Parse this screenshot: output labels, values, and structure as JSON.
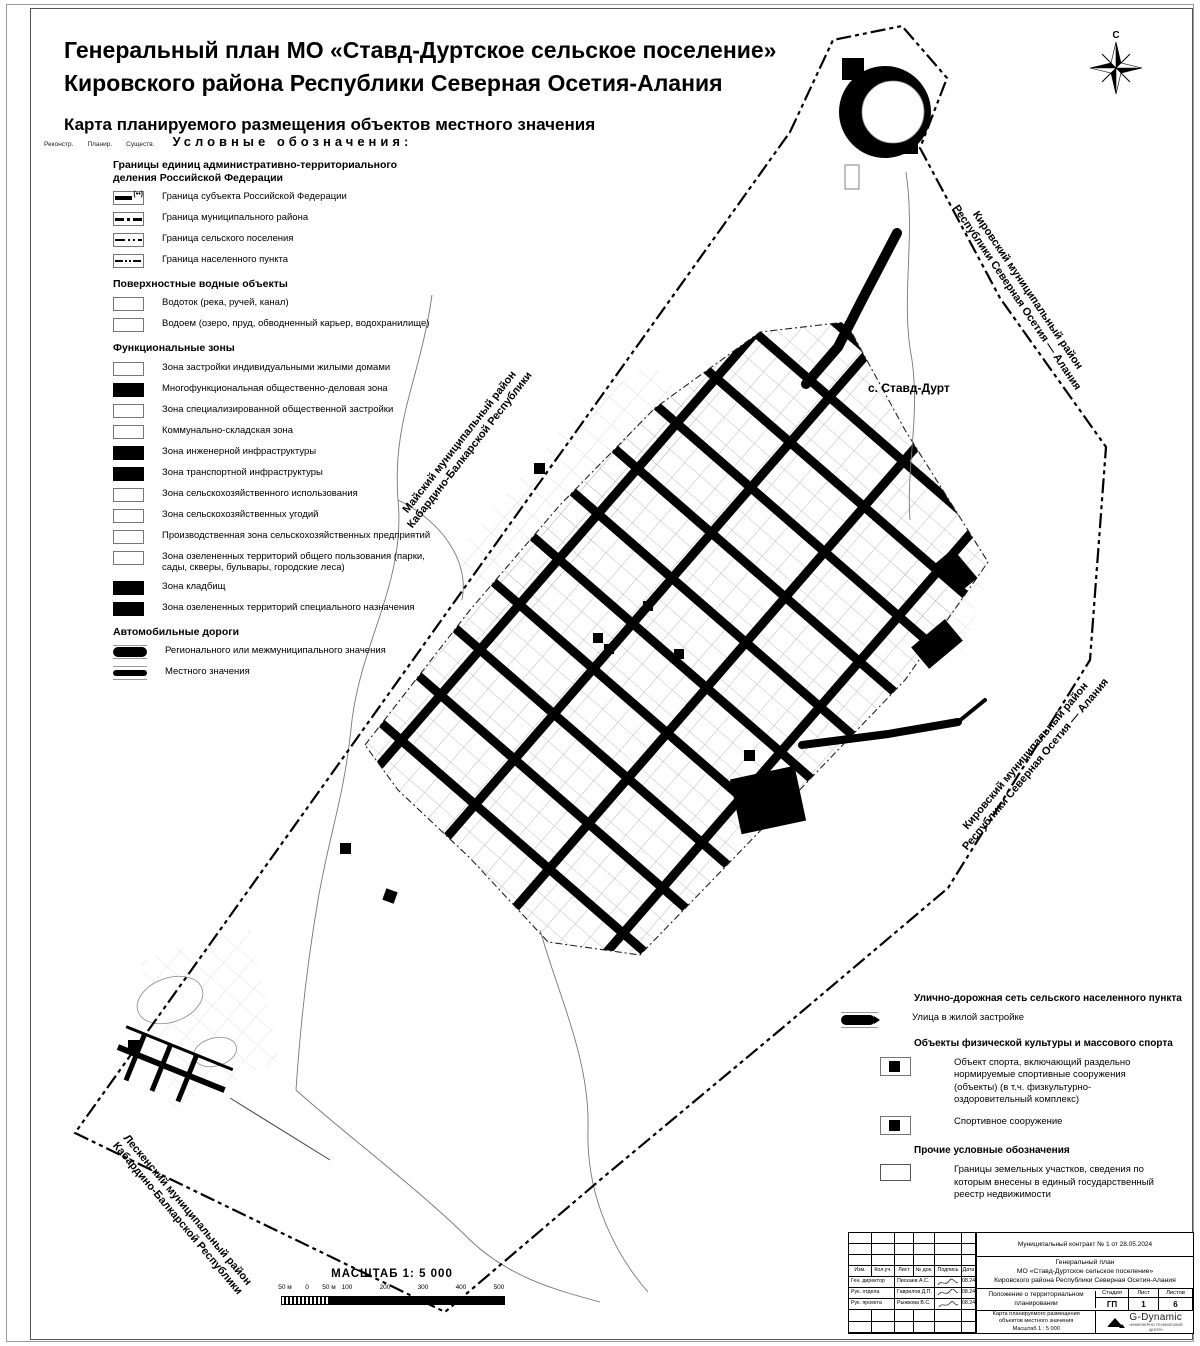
{
  "header": {
    "title_line1": "Генеральный план МО «Ставд-Дуртское сельское поселение»",
    "title_line2": "Кировского района Республики Северная Осетия-Алания",
    "subtitle": "Карта планируемого размещения объектов местного значения"
  },
  "compass": {
    "north_label": "С"
  },
  "legend": {
    "status_labels": [
      "Реконстр.",
      "Планир.",
      "Существ."
    ],
    "heading": "Условные обозначения:",
    "sections": [
      {
        "title": "Границы единиц административно-территориального\nделения Российской Федерации",
        "items": [
          {
            "symbol": "boundary-subject",
            "label": "Граница субъекта Российской Федерации"
          },
          {
            "symbol": "boundary-district",
            "label": "Граница муниципального района"
          },
          {
            "symbol": "boundary-settlement",
            "label": "Граница сельского поселения"
          },
          {
            "symbol": "boundary-locality",
            "label": "Граница населенного пункта"
          }
        ]
      },
      {
        "title": "Поверхностные водные объекты",
        "items": [
          {
            "symbol": "zone-white",
            "label": "Водоток (река, ручей, канал)"
          },
          {
            "symbol": "zone-white",
            "label": "Водоем (озеро, пруд, обводненный карьер, водохранилище)"
          }
        ]
      },
      {
        "title": "Функциональные зоны",
        "items": [
          {
            "symbol": "zone-white",
            "label": "Зона застройки индивидуальными жилыми домами"
          },
          {
            "symbol": "zone-black",
            "label": "Многофункциональная общественно-деловая зона"
          },
          {
            "symbol": "zone-white",
            "label": "Зона специализированной общественной застройки"
          },
          {
            "symbol": "zone-white",
            "label": "Коммунально-складская зона"
          },
          {
            "symbol": "zone-black",
            "label": "Зона инженерной инфраструктуры"
          },
          {
            "symbol": "zone-black",
            "label": "Зона транспортной инфраструктуры"
          },
          {
            "symbol": "zone-white",
            "label": "Зона сельскохозяйственного использования"
          },
          {
            "symbol": "zone-white",
            "label": "Зона сельскохозяйственных угодий"
          },
          {
            "symbol": "zone-white",
            "label": "Производственная зона сельскохозяйственных предприятий"
          },
          {
            "symbol": "zone-white",
            "label": "Зона озелененных территорий общего пользования (парки, сады, скверы, бульвары, городские леса)"
          },
          {
            "symbol": "zone-black",
            "label": "Зона кладбищ"
          },
          {
            "symbol": "zone-black",
            "label": "Зона озелененных территорий специального назначения"
          }
        ]
      },
      {
        "title": "Автомобильные дороги",
        "items": [
          {
            "symbol": "road-regional",
            "label": "Регионального или межмуниципального значения"
          },
          {
            "symbol": "road-local",
            "label": "Местного значения"
          }
        ]
      }
    ]
  },
  "legend_right": {
    "street_section_title": "Улично-дорожная сеть сельского населенного пункта",
    "street_label": "Улица в жилой застройке",
    "sport_section_title": "Объекты физической культуры и массового спорта",
    "sport_items": [
      {
        "symbol": "sport",
        "label": "Объект спорта, включающий раздельно нормируемые спортивные сооружения (объекты) (в т.ч. физкультурно-оздоровительный комплекс)"
      },
      {
        "symbol": "sport",
        "label": "Спортивное сооружение"
      }
    ],
    "other_section_title": "Прочие условные обозначения",
    "other_label": "Границы земельных участков, сведения по которым внесены в единый государственный реестр недвижимости"
  },
  "map": {
    "settlement_label": "с. Ставд-Дурт",
    "boundary_labels": {
      "kirovsky_ne_1": "Кировский муниципальный район",
      "kirovsky_ne_2": "Республики Северная Осетия — Алания",
      "kirovsky_se_1": "Кировский муниципальный район",
      "kirovsky_se_2": "Республики Северная Осетия — Алания",
      "maysky_1": "Майский муниципальный район",
      "maysky_2": "Кабардино-Балкарской Республики",
      "leskensky_1": "Лескенский муниципальный район",
      "leskensky_2": "Кабардино-Балкарской Республики"
    }
  },
  "scalebar": {
    "title": "МАСШТАБ 1: 5 000",
    "ticks": [
      "50 м",
      "0",
      "50 м",
      "100",
      "200",
      "300",
      "400",
      "500"
    ]
  },
  "titleblock": {
    "contract": "Муниципальный контракт № 1 от 28.05.2024",
    "project_lines": [
      "Генеральный план",
      "МО «Ставд-Дуртское сельское поселение»",
      "Кировского района Республики Северная Осетия-Алания"
    ],
    "doc_title": "Положение о территориальном планировании",
    "stage_headers": [
      "Стадия",
      "Лист",
      "Листов"
    ],
    "stage_values": [
      "ГП",
      "1",
      "6"
    ],
    "caption_lines": [
      "Карта планируемого размещения",
      "объектов местного значения",
      "Масштаб 1 : 5 000"
    ],
    "columns": [
      "Изм.",
      "Кол.уч.",
      "Лист",
      "№ док.",
      "Подпись",
      "Дата"
    ],
    "rows": [
      {
        "role": "Ген. директор",
        "name": "Пискаев А.С.",
        "date": "08.24"
      },
      {
        "role": "Рук. отдела",
        "name": "Гаврилов Д.П.",
        "date": "08.24"
      },
      {
        "role": "Рук. проекта",
        "name": "Рыжкова В.С.",
        "date": "08.24"
      }
    ],
    "logo_name": "G-Dynamic",
    "logo_sub_1": "«ИНЖЕНЕРНО-ТЕХНИЧЕСКИЙ",
    "logo_sub_2": "ЦЕНТР»"
  }
}
